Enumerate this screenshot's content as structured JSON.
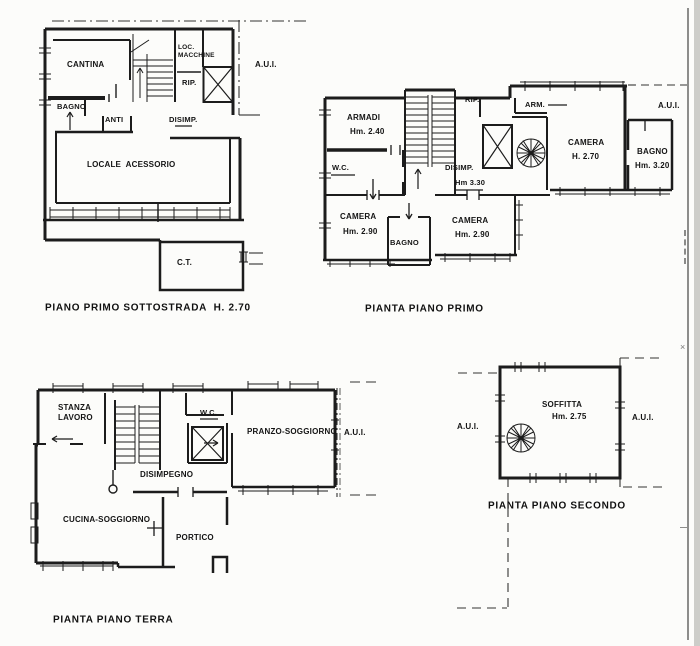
{
  "sheet": {
    "background": "#fcfcfa",
    "ink": "#1a1a1a",
    "border_color": "#8d8d8b"
  },
  "plans": {
    "sottostrada": {
      "caption": "PIANO PRIMO SOTTOSTRADA  H. 2.70",
      "labels": {
        "cantina": "CANTINA",
        "bagno": "BAGNO",
        "anti": "ANTI",
        "loc_macchine_1": "LOC.",
        "loc_macchine_2": "MACCHINE",
        "rip": "RIP.",
        "disimp": "DISIMP.",
        "aui": "A.U.I.",
        "locale_acessorio": "LOCALE  ACESSORIO",
        "ct": "C.T."
      }
    },
    "primo": {
      "caption": "PIANTA PIANO PRIMO",
      "labels": {
        "armadi_1": "ARMADI",
        "armadi_2": "Hm. 2.40",
        "wc": "W.C.",
        "rip": "RIP.",
        "arm": "ARM.",
        "camera_centro_1": "CAMERA",
        "camera_centro_2": "H. 2.70",
        "aui": "A.U.I.",
        "bagno_dx_1": "BAGNO",
        "bagno_dx_2": "Hm. 3.20",
        "disimp_1": "DISIMP.",
        "disimp_2": "Hm 3.30",
        "camera_sx_1": "CAMERA",
        "camera_sx_2": "Hm. 2.90",
        "bagno_centro": "BAGNO",
        "camera_dx_1": "CAMERA",
        "camera_dx_2": "Hm. 2.90"
      }
    },
    "terra": {
      "caption": "PIANTA PIANO TERRA",
      "labels": {
        "stanza_1": "STANZA",
        "stanza_2": "LAVORO",
        "wc": "W.C.",
        "pranzo": "PRANZO-SOGGIORNO",
        "aui": "A.U.I.",
        "disimpegno": "DISIMPEGNO",
        "cucina": "CUCINA-SOGGIORNO",
        "portico": "PORTICO"
      }
    },
    "secondo": {
      "caption": "PIANTA PIANO SECONDO",
      "labels": {
        "soffitta_1": "SOFFITTA",
        "soffitta_2": "Hm. 2.75",
        "aui_left": "A.U.I.",
        "aui_right": "A.U.I."
      }
    }
  }
}
